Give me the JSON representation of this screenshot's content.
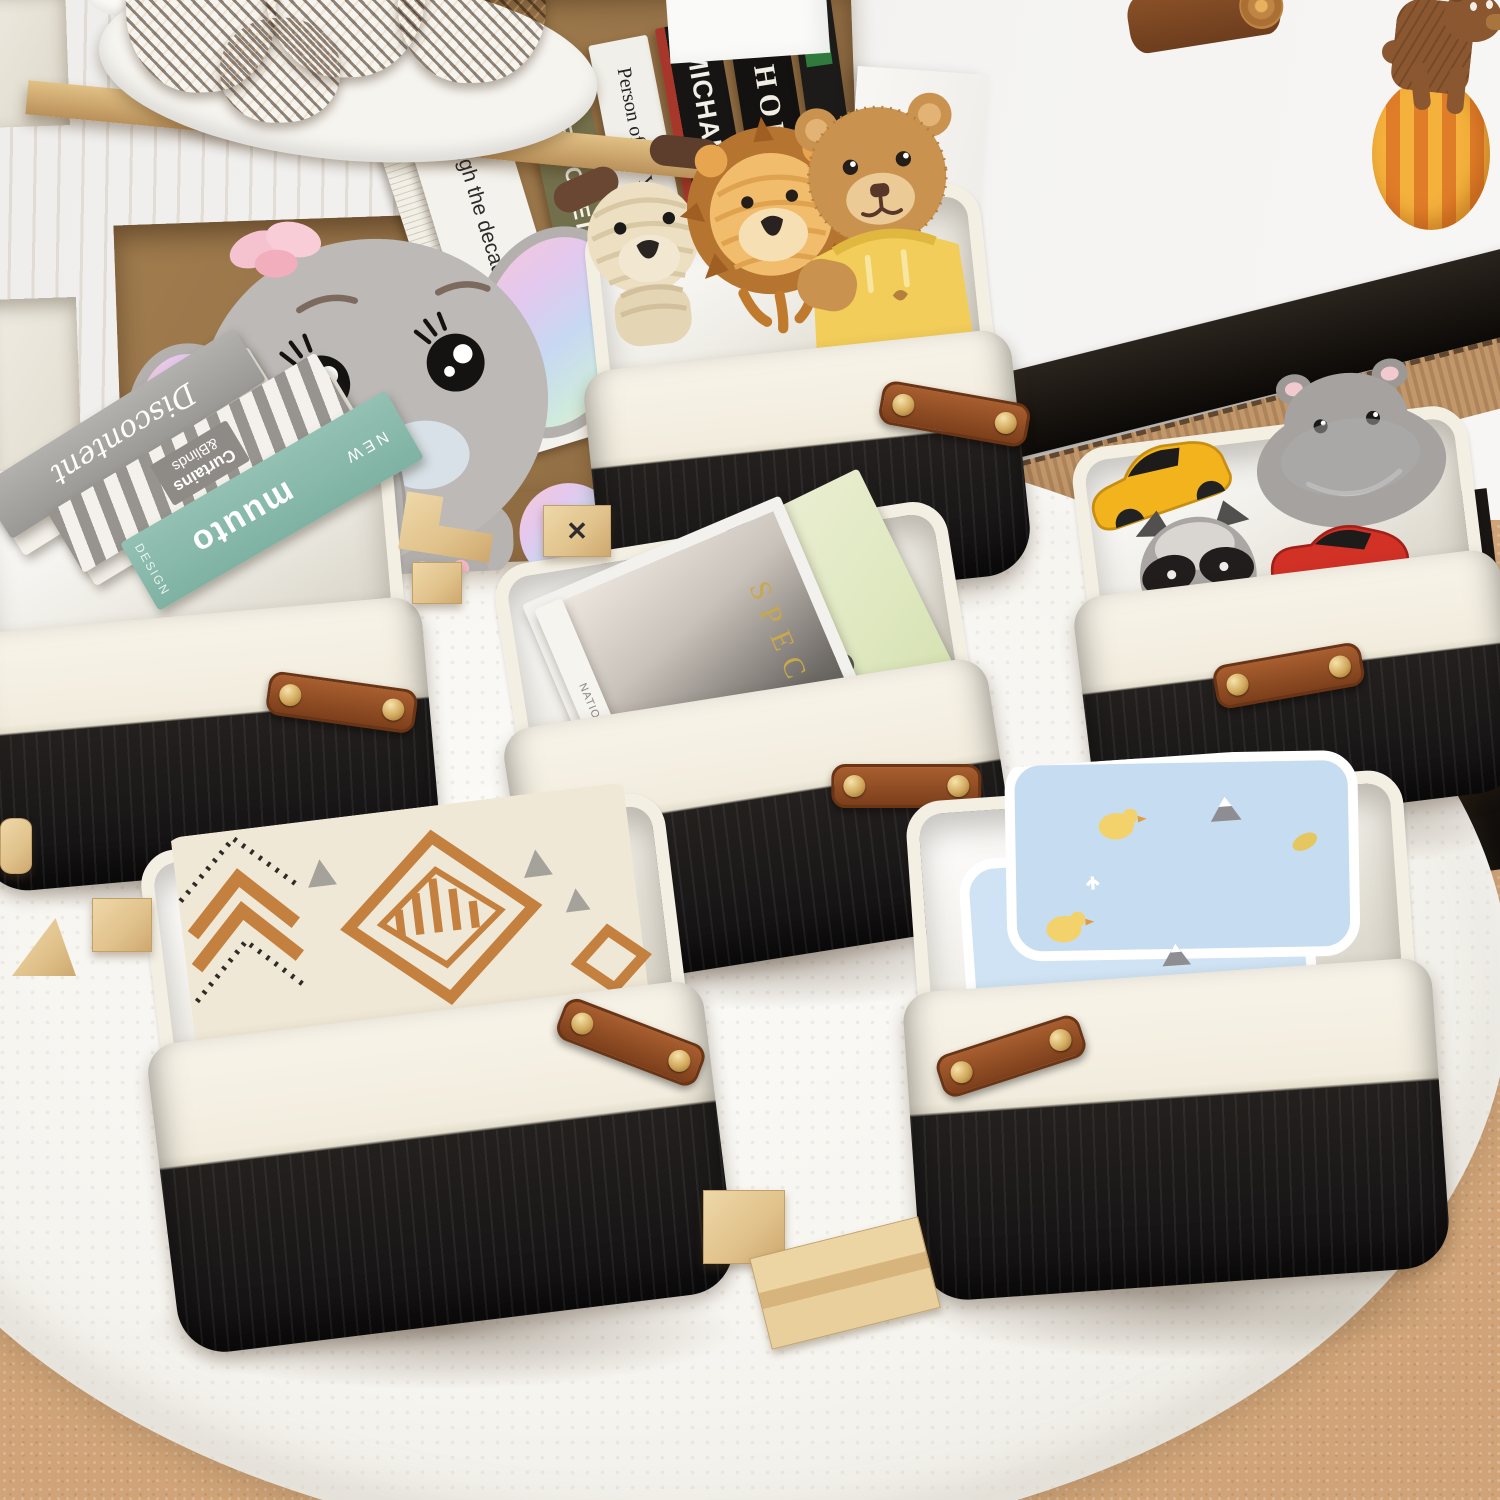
{
  "scene": {
    "title": "Black and white fabric storage baskets in a children's playroom",
    "floor": "tan carpet with round white fluffy rug",
    "wall": "white wall with black baseboard"
  },
  "colors": {
    "basket_rim": "#f5f1e6",
    "basket_body": "#201d1c",
    "basket_lining": "#efece3",
    "handle_leather": "#95522b",
    "rivet_gold": "#d9b66c",
    "rug": "#f8f6f1",
    "carpet": "#d2a77c",
    "wood_shelf": "#c9a26b",
    "wall": "#f2f1ee",
    "baseboard": "#1a1713"
  },
  "wall_decals": {
    "log": "wooden log sticker",
    "bear": "brown bear on orange striped ball sticker"
  },
  "shelf": {
    "plate": "white plate of pinecones",
    "elephant": "grey plush elephant with pastel rainbow ears and pink flower",
    "books": [
      {
        "title": "Jazz through the decades",
        "footer": "TASCHEN"
      },
      {
        "title": "THE HOTEL BOOK",
        "footer": ""
      },
      {
        "title": "Person of the Year",
        "footer": "TIM"
      },
      {
        "title": "MICHAEL JA",
        "footer": ""
      },
      {
        "title": "HOME",
        "footer": "",
        "ornament": "❁"
      }
    ]
  },
  "baskets": {
    "top": {
      "contents": "corduroy dog, corduroy lion, teddy bear in yellow hoodie"
    },
    "right": {
      "contents": "yellow toy car, plush hippo, plush raccoon, red toy car"
    },
    "left": {
      "book1": "Discontent",
      "book2_line1": "Curtains",
      "book2_line2": "&Blinds",
      "book3_brand": "muuto",
      "book3_tag": "NEW",
      "book3_side": "DESIGN"
    },
    "center": {
      "magazine_title": "SPECIAL",
      "magazine_spine": "NATIO GEOGR",
      "magazine_back": "R"
    },
    "bottom_left": {
      "contents": "aztec pattern knit blanket"
    },
    "bottom_right": {
      "contents": "blue baby blanket with chick print"
    }
  },
  "toys": {
    "x_block": "✕"
  }
}
